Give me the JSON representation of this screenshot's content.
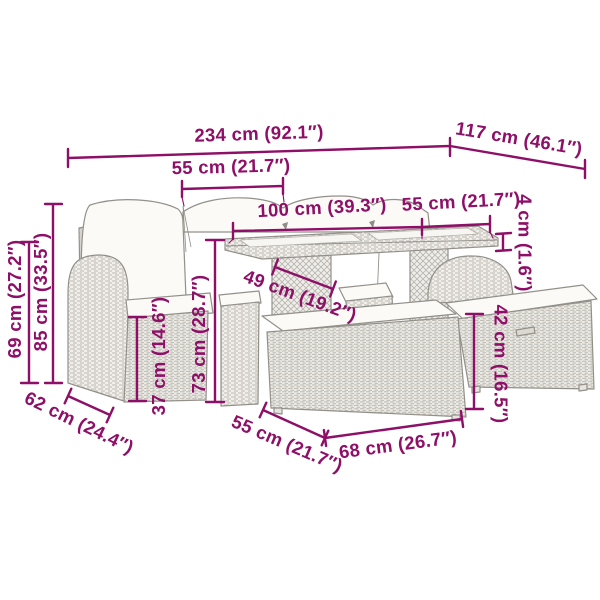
{
  "accent_color": "#8e0f68",
  "diagram": {
    "kind": "furniture-dimension-diagram",
    "pieces": [
      "corner-sofa",
      "rear-sofa-cushions",
      "stool",
      "dining-table",
      "under-table-stool",
      "front-ottoman",
      "right-stool"
    ],
    "labels": {
      "overall_width": "234 cm (92.1″)",
      "overall_depth": "117 cm (46.1″)",
      "seat_width": "55 cm (21.7″)",
      "table_length": "100 cm (39.3″)",
      "table_depth": "55 cm (21.7″)",
      "tabletop_thickness": "4 cm (1.6″)",
      "armrest_height": "69 cm (27.2″)",
      "back_height": "85 cm (33.5″)",
      "seat_height": "37 cm (14.6″)",
      "table_height": "73 cm (28.7″)",
      "under_table_clearance": "49 cm (19.2″)",
      "stool_height": "42 cm (16.5″)",
      "sofa_depth": "62 cm (24.4″)",
      "ottoman_depth": "55 cm (21.7″)",
      "ottoman_width": "68 cm (26.7″)"
    }
  }
}
